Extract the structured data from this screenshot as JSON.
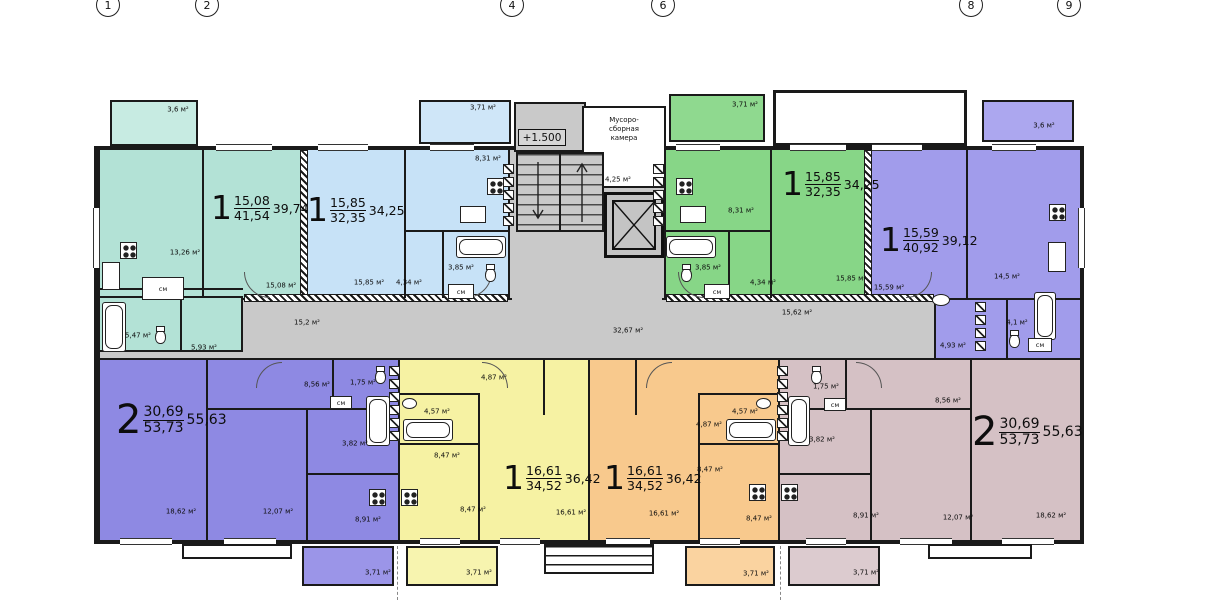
{
  "axis_markers": [
    "1",
    "2",
    "4",
    "6",
    "8",
    "9"
  ],
  "shared": {
    "closet": "см"
  },
  "stair_block": {
    "elevation": "+1.500",
    "garbage_line1": "Мусоро-",
    "garbage_line2": "сборная",
    "garbage_line3": "камера",
    "garbage_area": "4,25 м²"
  },
  "corridors": {
    "left": "15,2 м²",
    "center": "32,67 м²",
    "right": "15,62 м²"
  },
  "apartments": {
    "teal": {
      "num": "1",
      "area_top": "15,08",
      "area_bottom": "41,54",
      "area_right": "39,74",
      "balcony": "3,6 м²",
      "kitchen": "13,26 м²",
      "room": "15,08 м²",
      "bath": "5,47 м²",
      "hall": "5,93 м²"
    },
    "blue": {
      "num": "1",
      "area_top": "15,85",
      "area_bottom": "32,35",
      "area_right": "34,25",
      "balcony": "3,71 м²",
      "kitchen": "8,31 м²",
      "room": "15,85 м²",
      "hall": "4,34 м²",
      "bath": "3,85 м²"
    },
    "green": {
      "num": "1",
      "area_top": "15,85",
      "area_bottom": "32,35",
      "area_right": "34,25",
      "balcony": "3,71 м²",
      "kitchen": "8,31 м²",
      "room": "15,85 м²",
      "hall": "4,34 м²",
      "bath": "3,85 м²"
    },
    "purple_top": {
      "num": "1",
      "area_top": "15,59",
      "area_bottom": "40,92",
      "area_right": "39,12",
      "balcony": "3,6 м²",
      "room": "15,59 м²",
      "kitchen": "14,5 м²",
      "hall": "4,93 м²",
      "bath": "4,1 м²"
    },
    "purple_bottom": {
      "num": "2",
      "area_top": "30,69",
      "area_bottom": "53,73",
      "area_right": "55,63",
      "balcony": "3,71 м²",
      "room1": "18,62 м²",
      "room2": "12,07 м²",
      "kitchen2": "8,56 м²",
      "wc": "1,75 м²",
      "bath": "3,82 м²",
      "kitchen": "8,91 м²"
    },
    "yellow": {
      "num": "1",
      "area_top": "16,61",
      "area_bottom": "34,52",
      "area_right": "36,42",
      "balcony": "3,71 м²",
      "hall": "4,87 м²",
      "bath": "4,57 м²",
      "kitchen_a": "8,47 м²",
      "kitchen_b": "8,47 м²",
      "room": "16,61 м²"
    },
    "orange": {
      "num": "1",
      "area_top": "16,61",
      "area_bottom": "34,52",
      "area_right": "36,42",
      "balcony": "3,71 м²",
      "hall": "4,87 м²",
      "bath": "4,57 м²",
      "kitchen_a": "8,47 м²",
      "kitchen_b": "8,47 м²",
      "room": "16,61 м²"
    },
    "beige": {
      "num": "2",
      "area_top": "30,69",
      "area_bottom": "53,73",
      "area_right": "55,63",
      "balcony": "3,71 м²",
      "room1": "18,62 м²",
      "room2": "12,07 м²",
      "kitchen2": "8,56 м²",
      "wc": "1,75 м²",
      "bath": "3,82 м²",
      "kitchen": "8,91 м²"
    }
  },
  "colors": {
    "teal": "#b3e2d6",
    "blue": "#c7e2f7",
    "green": "#87d687",
    "purple_top": "#a19ceb",
    "purple_bottom": "#8e89e3",
    "yellow": "#f6f2a3",
    "orange": "#f8c98d",
    "beige": "#d5c1c5",
    "corridor": "#c9c9c9",
    "wall": "#1a1a1a"
  }
}
